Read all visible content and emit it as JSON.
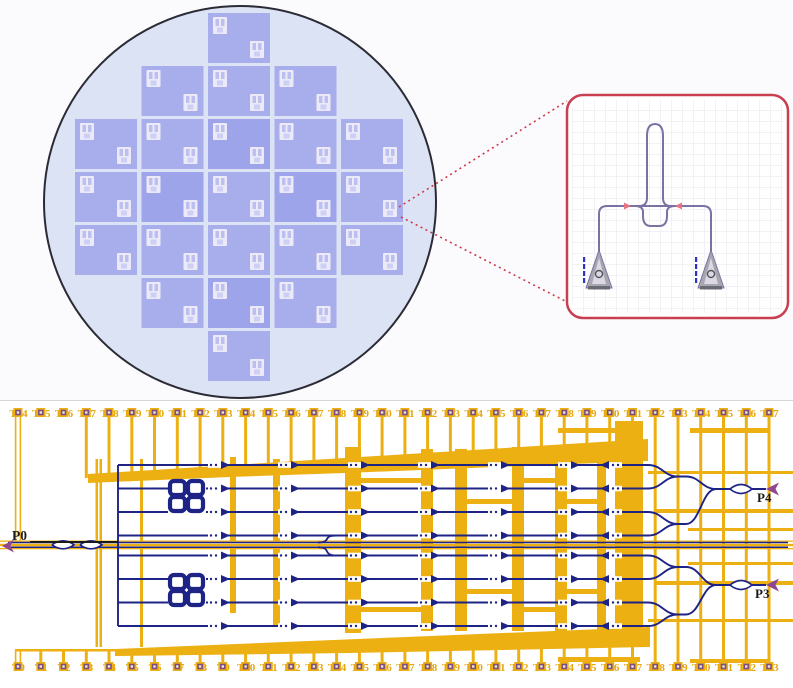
{
  "figure": {
    "wafer": {
      "name": "wafer-die-map",
      "die_rows": [
        [
          2
        ],
        [
          1,
          2,
          3
        ],
        [
          0,
          1,
          2,
          3,
          4
        ],
        [
          0,
          1,
          2,
          3,
          4
        ],
        [
          0,
          1,
          2,
          3,
          4
        ],
        [
          1,
          2,
          3
        ],
        [
          2
        ]
      ],
      "dark_dies": [
        [
          2,
          2
        ],
        [
          3,
          3
        ],
        [
          3,
          1
        ],
        [
          5,
          2
        ]
      ]
    },
    "inset": {
      "name": "die-detail-callout"
    },
    "chip": {
      "top_pads": [
        "T34",
        "T35",
        "T36",
        "T37",
        "T38",
        "T39",
        "T40",
        "T41",
        "T42",
        "T43",
        "T44",
        "T45",
        "T46",
        "T47",
        "T48",
        "T49",
        "T50",
        "T51",
        "T52",
        "T53",
        "T54",
        "T55",
        "T56",
        "T57",
        "T58",
        "T59",
        "T60",
        "T61",
        "T62",
        "T63",
        "T64",
        "T65",
        "T66",
        "T67"
      ],
      "bottom_pads": [
        "T0",
        "T1",
        "T2",
        "T3",
        "T4",
        "T5",
        "T6",
        "T7",
        "T8",
        "T9",
        "T10",
        "T11",
        "T12",
        "T13",
        "T14",
        "T15",
        "T16",
        "T17",
        "T18",
        "T19",
        "T20",
        "T21",
        "T22",
        "T23",
        "T24",
        "T25",
        "T26",
        "T27",
        "T28",
        "T29",
        "T30",
        "T31",
        "T32",
        "T33"
      ],
      "ports": {
        "left": "P0",
        "right_top": "P4",
        "right_bottom": "P3"
      }
    },
    "colors": {
      "metal_orange": "#ecb012",
      "waveguide_navy": "#1e2386",
      "pad_inner_purple": "#7c4e82",
      "pad_center": "#f0e6c8",
      "label_orange": "#e7a70e",
      "port_text_black": "#1a1a1a",
      "port_arrow_magenta": "#8e4790",
      "callout_red": "#c8404f",
      "wafer_fill": "#dce3f4",
      "wafer_stroke": "#2b2b35",
      "die_fill": "#a8aeec",
      "die_fill_dark": "#9da4e9",
      "die_mark": "#eceaf9",
      "inset_device": "#7b72a3",
      "grating_gray": "#a8a7b0"
    }
  }
}
